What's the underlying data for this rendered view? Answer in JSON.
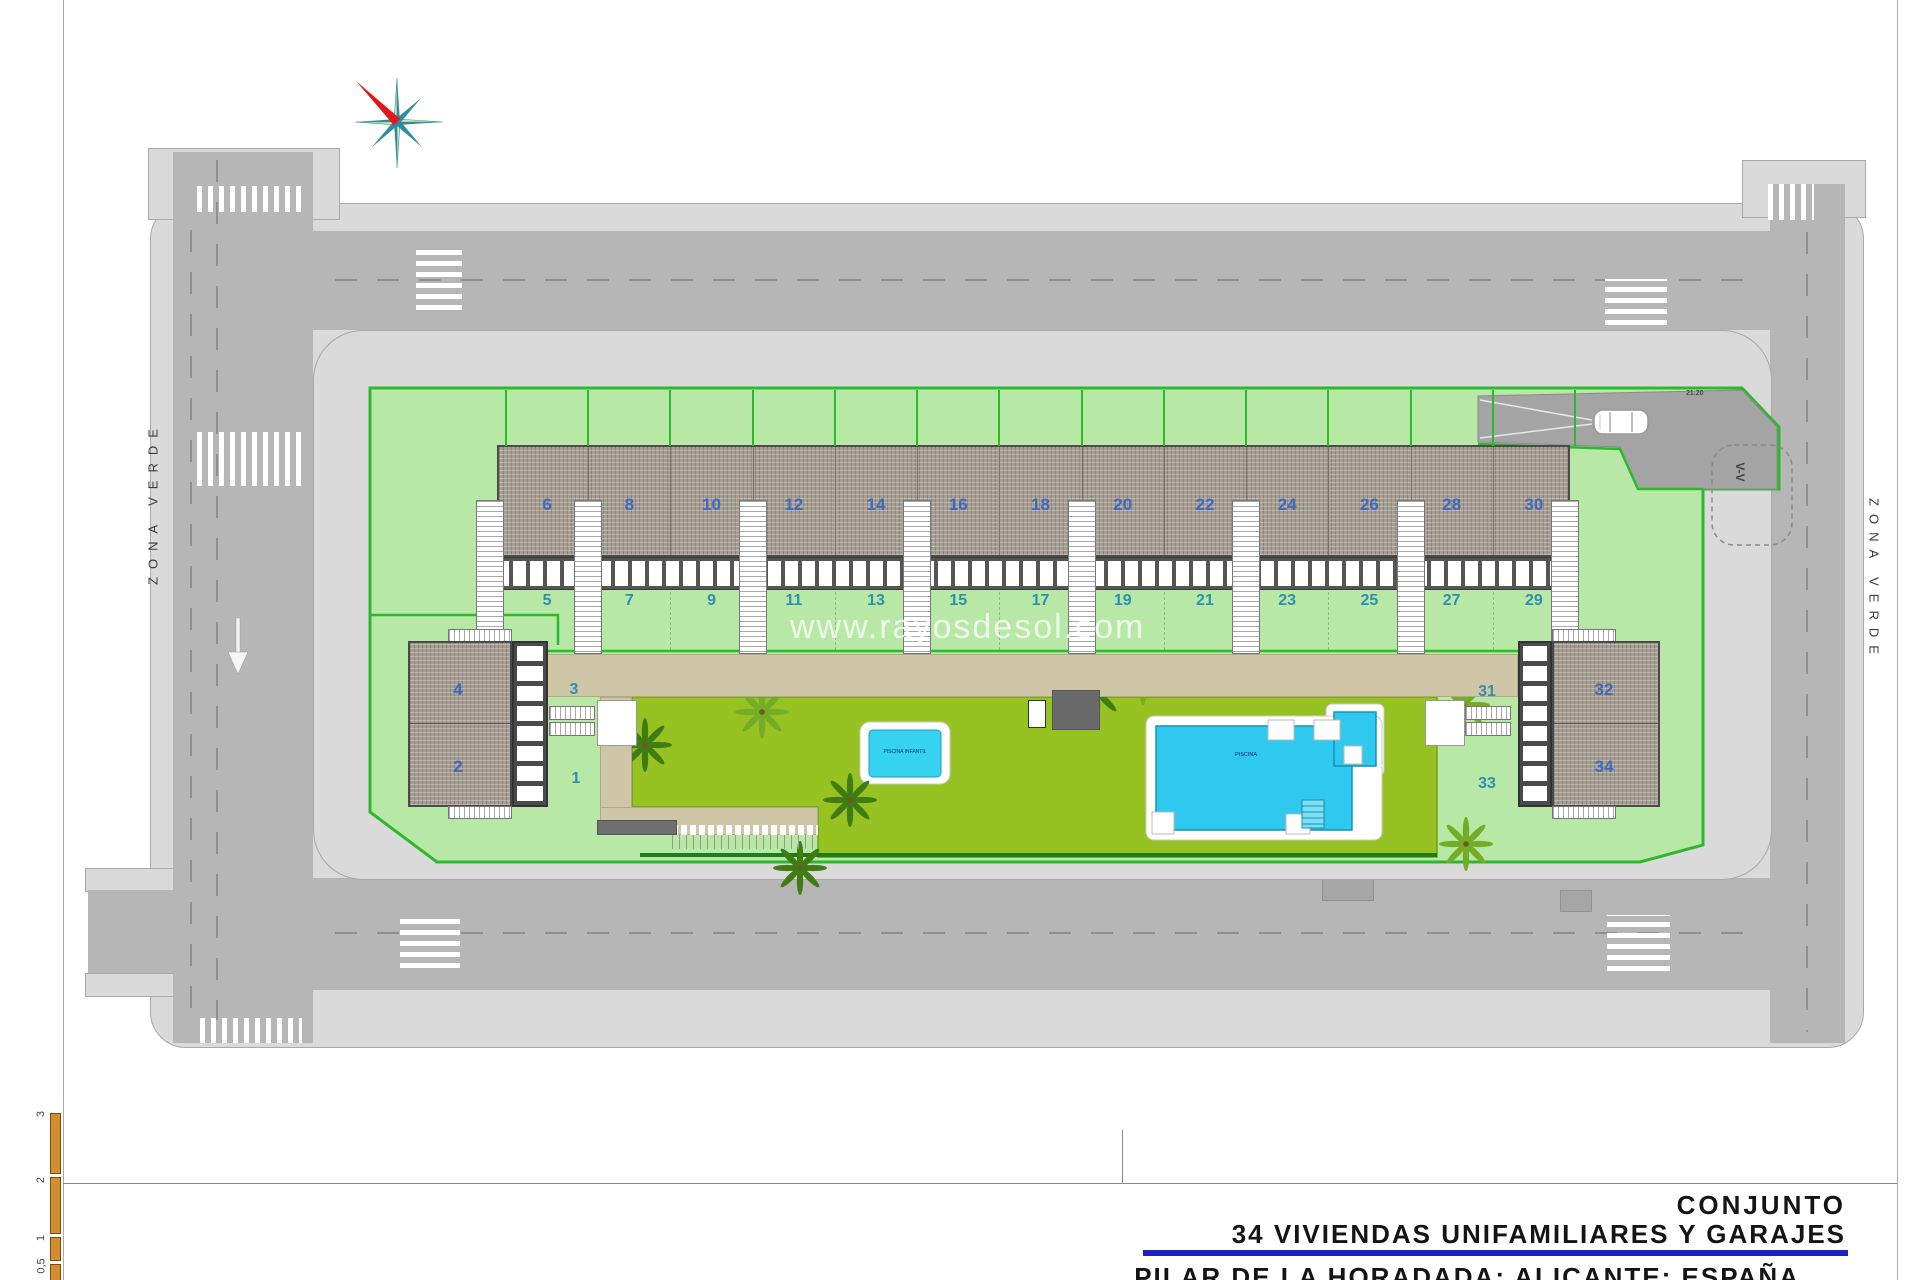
{
  "plan": {
    "watermark": "www.rayosdesol.com",
    "zona_verde_left": "ZONA VERDE",
    "zona_verde_right": "ZONA VERDE",
    "section_marker": "V-V",
    "ramp_level": "21.20",
    "pool_small_label": "PISCINA INFANTIL",
    "pool_large_label": "PISCINA",
    "units_top_buildings": [
      "6",
      "8",
      "10",
      "12",
      "14",
      "16",
      "18",
      "20",
      "22",
      "24",
      "26",
      "28",
      "30"
    ],
    "units_top_parcels": [
      "5",
      "7",
      "9",
      "11",
      "13",
      "15",
      "17",
      "19",
      "21",
      "23",
      "25",
      "27",
      "29"
    ],
    "left_block": {
      "buildings": [
        "4",
        "2"
      ],
      "parcels": [
        "3",
        "1"
      ]
    },
    "right_block": {
      "buildings": [
        "32",
        "34"
      ],
      "parcels": [
        "31",
        "33"
      ]
    }
  },
  "scale_bar": {
    "labels": [
      "3",
      "2",
      "1",
      "0,5"
    ]
  },
  "title_block": {
    "line1": "CONJUNTO",
    "line2": "34 VIVIENDAS UNIFAMILIARES Y GARAJES",
    "line3": "PILAR DE LA HORADADA; ALICANTE; ESPAÑA"
  },
  "icons": {
    "compass_rose": "8-point star",
    "palm_tree": "palm top view",
    "car": "car top view",
    "direction_arrow": "down arrow"
  },
  "colors": {
    "plot_green": "#b7e8a6",
    "plot_border": "#2db82d",
    "garden_green": "#97c322",
    "pool_cyan": "#2fc8ee",
    "road_gray": "#b6b6b6",
    "sidewalk_gray": "#dadada",
    "unit_number_blue": "#3f6abc",
    "parcel_number_teal": "#2f8fb0",
    "title_underline_blue": "#2020c0",
    "scale_bar_orange": "#d28e2f",
    "compass_red": "#e01818",
    "compass_teal": "#2e8ba0"
  }
}
